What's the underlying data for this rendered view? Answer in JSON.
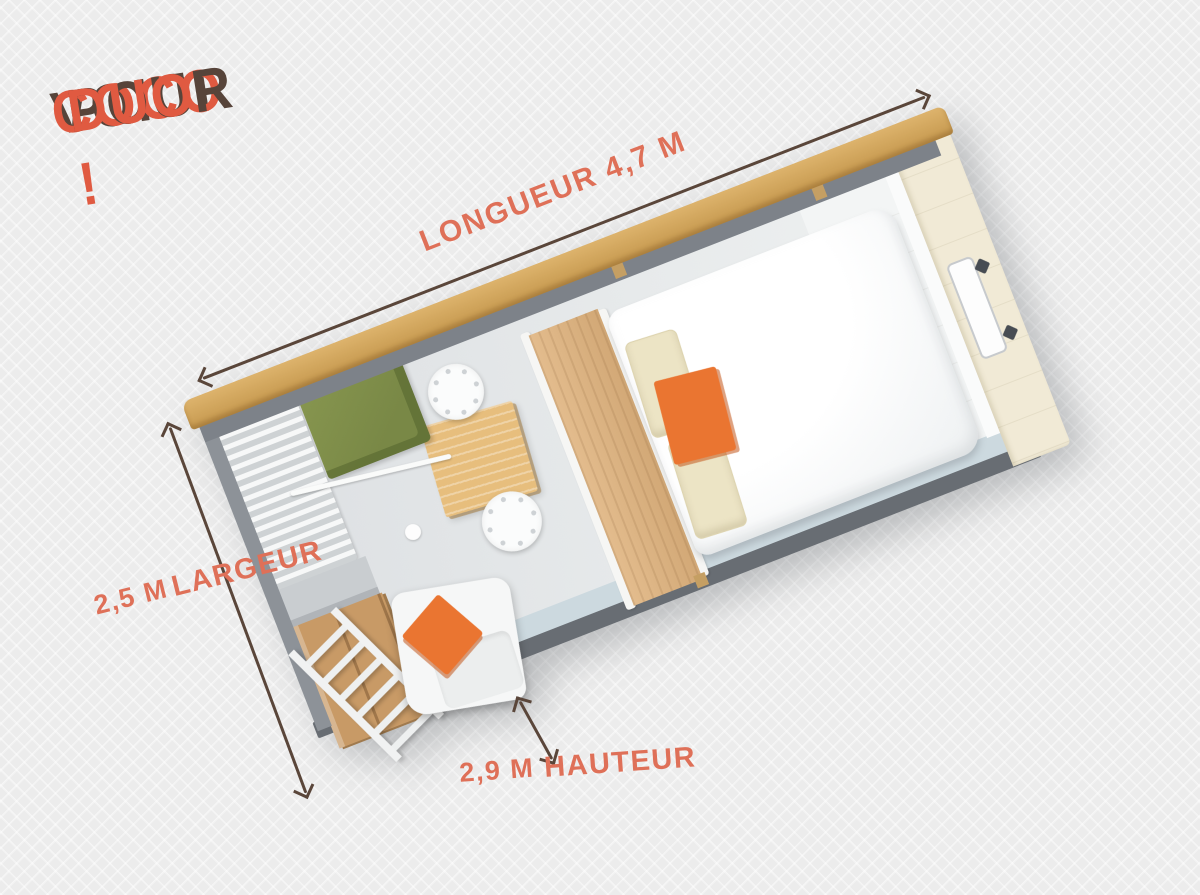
{
  "title": {
    "word1": "VOICI",
    "word2": "COCO",
    "word3": "POUR",
    "word4": "DUO !"
  },
  "dimensions": {
    "length_label": "LONGUEUR 4,7 M",
    "width_label": "LARGEUR",
    "width_value": "2,5 M",
    "height_label": "HAUTEUR",
    "height_value": "2,9 M"
  },
  "colors": {
    "background_gray": "#ececec",
    "text_brown": "#57443a",
    "title_orange": "#e05a41",
    "label_orange": "#df7058",
    "arrow_brown": "#5a463a",
    "roof_wood": "#d0a35e",
    "wall_gray": "#7d8289",
    "floor_gray": "#e4e7e9",
    "inner_wall_blue_gray": "#ccd9df",
    "end_wall_cream": "#f1ead6",
    "bench_green": "#7e8d4b",
    "deck_wood": "#c89a66",
    "table_wood": "#e7be7d",
    "headboard_wood": "#d9b07e",
    "cushion_orange": "#ea7531",
    "pillow_cream": "#ece4c5",
    "bed_white": "#ffffff"
  }
}
